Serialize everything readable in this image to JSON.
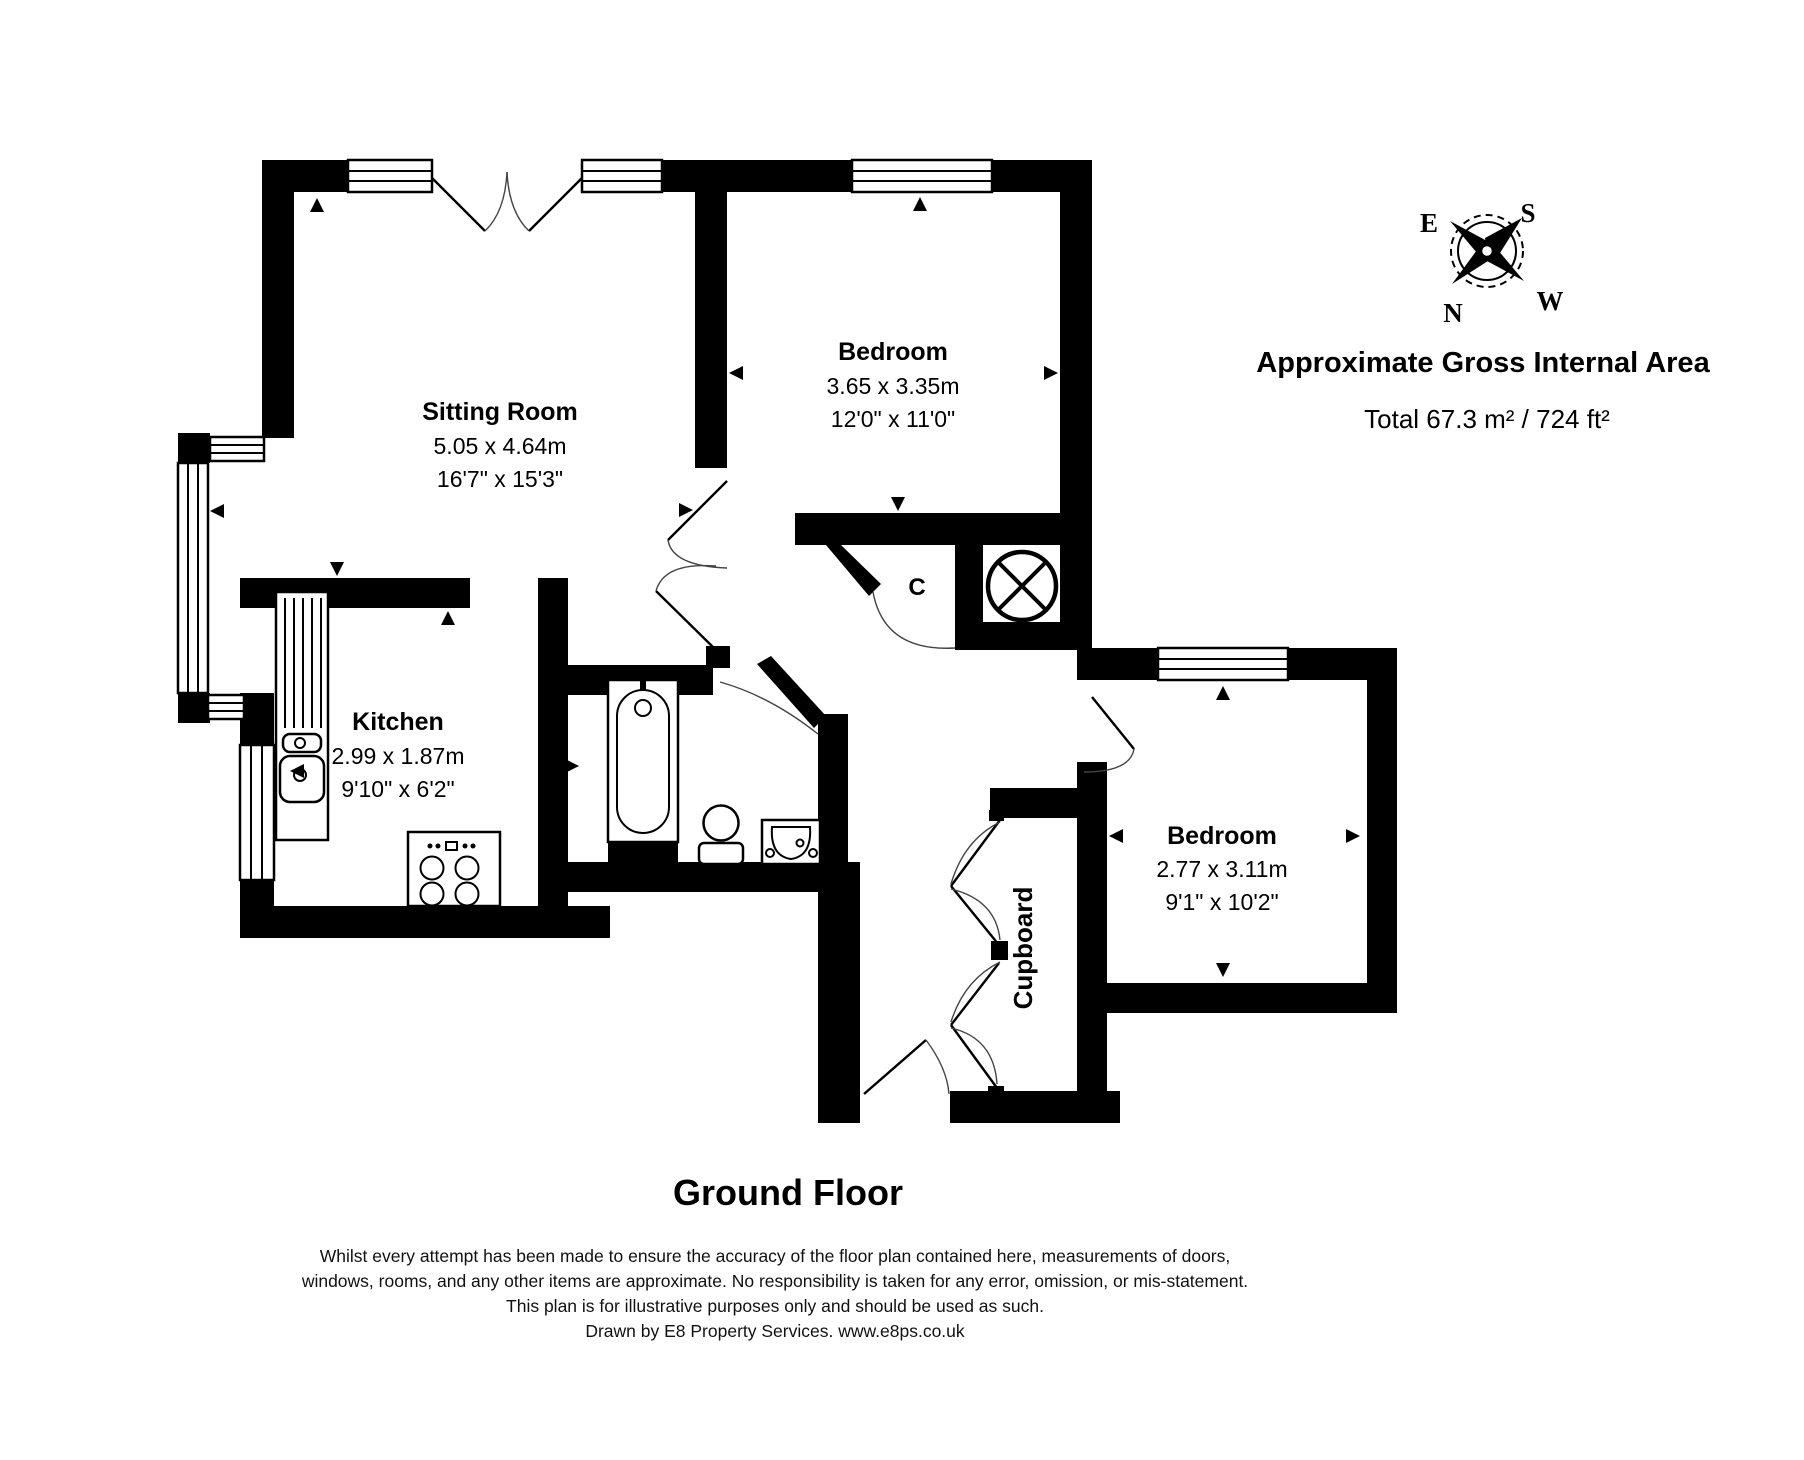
{
  "title": "Ground Floor",
  "area_panel": {
    "heading": "Approximate Gross Internal Area",
    "total": "Total 67.3 m² / 724 ft²"
  },
  "compass": {
    "n": "N",
    "e": "E",
    "s": "S",
    "w": "W"
  },
  "rooms": {
    "sitting_room": {
      "name": "Sitting Room",
      "metric": "5.05 x 4.64m",
      "imperial": "16'7\" x 15'3\""
    },
    "bedroom1": {
      "name": "Bedroom",
      "metric": "3.65 x 3.35m",
      "imperial": "12'0\" x 11'0\""
    },
    "kitchen": {
      "name": "Kitchen",
      "metric": "2.99 x 1.87m",
      "imperial": "9'10\" x 6'2\""
    },
    "bedroom2": {
      "name": "Bedroom",
      "metric": "2.77 x 3.11m",
      "imperial": "9'1\" x 10'2\""
    },
    "closet": {
      "name": "C"
    },
    "cupboard": {
      "name": "Cupboard"
    }
  },
  "disclaimer": {
    "line1": "Whilst every attempt has been made to ensure the accuracy of the floor plan contained here, measurements of doors,",
    "line2": "windows, rooms, and any other items are approximate. No responsibility is taken for any error, omission, or mis-statement.",
    "line3": "This plan is for illustrative purposes only and should be used as such.",
    "line4": "Drawn by E8 Property Services. www.e8ps.co.uk"
  },
  "colors": {
    "wall": "#000000",
    "background": "#ffffff",
    "text": "#000000"
  }
}
